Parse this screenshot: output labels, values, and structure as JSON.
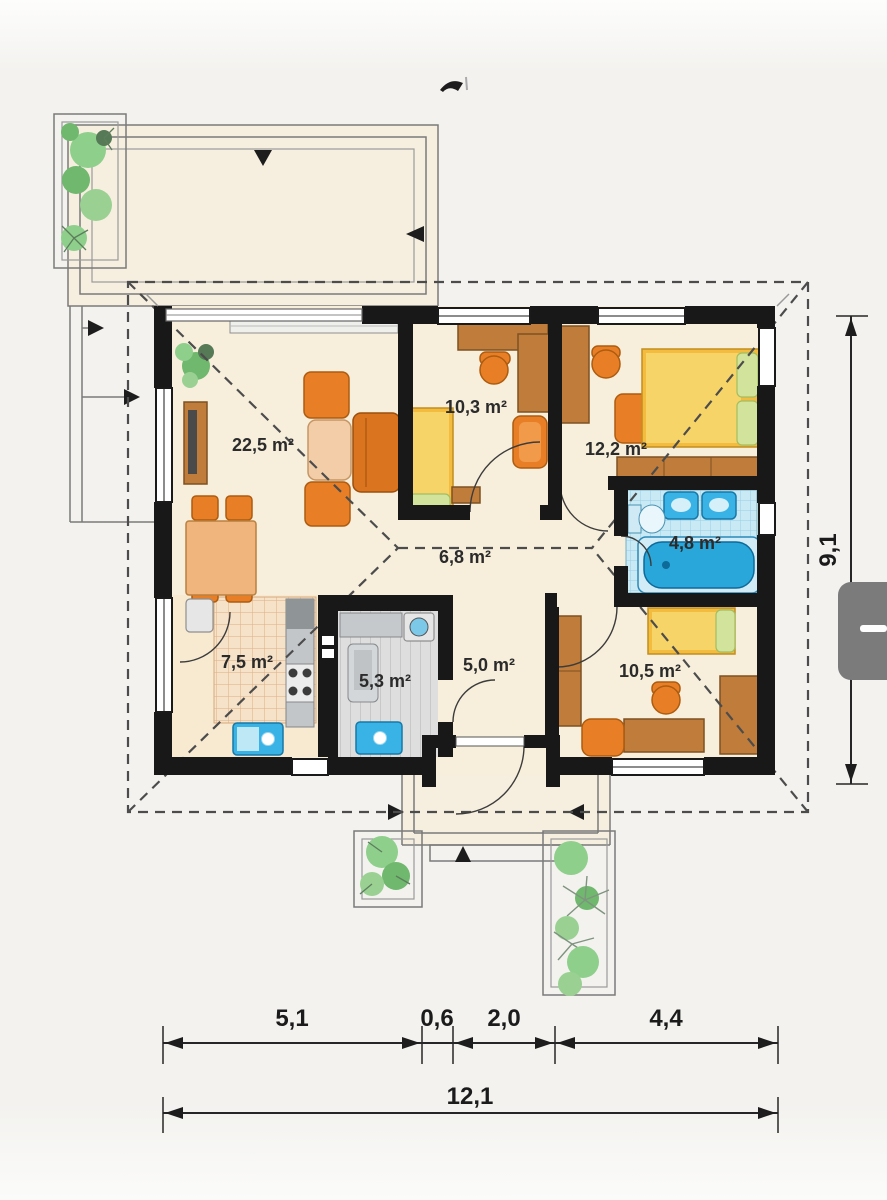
{
  "plan": {
    "rooms": [
      {
        "id": "living-room",
        "area_label": "22,5 m²"
      },
      {
        "id": "room-small-top",
        "area_label": "10,3 m²"
      },
      {
        "id": "bedroom",
        "area_label": "12,2 m²"
      },
      {
        "id": "hall",
        "area_label": "6,8 m²"
      },
      {
        "id": "bathroom",
        "area_label": "4,8 m²"
      },
      {
        "id": "kitchen",
        "area_label": "7,5 m²"
      },
      {
        "id": "utility",
        "area_label": "5,3 m²"
      },
      {
        "id": "entry",
        "area_label": "5,0 m²"
      },
      {
        "id": "room-small-bottom",
        "area_label": "10,5 m²"
      }
    ],
    "dimensions": {
      "bottom_segments": [
        "5,1",
        "0,6",
        "2,0",
        "4,4"
      ],
      "bottom_total": "12,1",
      "right_height": "9,1"
    },
    "colors": {
      "wall": "#181818",
      "floor": "#f7efdc",
      "wood": "#c07c3a",
      "furniture_orange": "#e87f26",
      "bed_yellow": "#f3bc3e",
      "bath_blue": "#39b3e5",
      "plant_green": "#8fcf8c",
      "roof_dash": "#4c4c4c",
      "overlay_button": "#7b7b7b"
    },
    "icons": {
      "overlay_handle": "minus-icon"
    }
  }
}
